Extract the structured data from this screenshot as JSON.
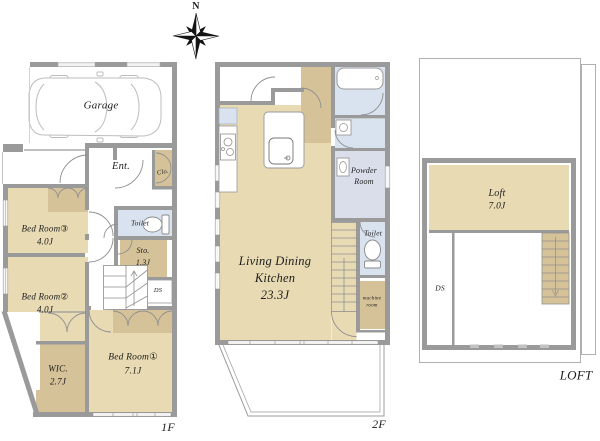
{
  "compass": {
    "north": "N"
  },
  "floors": {
    "f1": {
      "label": "1F",
      "garage": "Garage",
      "entrance": "Ent.",
      "closet": "Clo.",
      "toilet": "Toilet",
      "storage": "Sto.",
      "storage_size": "1.3J",
      "duct": "DS",
      "bedroom3": "Bed Room③",
      "bedroom3_size": "4.0J",
      "bedroom2": "Bed Room②",
      "bedroom2_size": "4.0J",
      "wic": "WIC.",
      "wic_size": "2.7J",
      "bedroom1": "Bed Room①",
      "bedroom1_size": "7.1J"
    },
    "f2": {
      "label": "2F",
      "ldk_line1": "Living Dining",
      "ldk_line2": "Kitchen",
      "ldk_size": "23.3J",
      "powder_line1": "Powder",
      "powder_line2": "Room",
      "toilet": "Toilet",
      "machine_line1": "machine",
      "machine_line2": "room"
    },
    "loft": {
      "label": "LOFT",
      "loft": "Loft",
      "loft_size": "7.0J",
      "duct": "DS"
    }
  },
  "colors": {
    "room_tan": "#e8dab3",
    "closet_tan": "#d6c298",
    "wet_blue": "#d9e2ef",
    "powder_blue": "#d9deea",
    "wall_gray": "#9a9a9a"
  }
}
